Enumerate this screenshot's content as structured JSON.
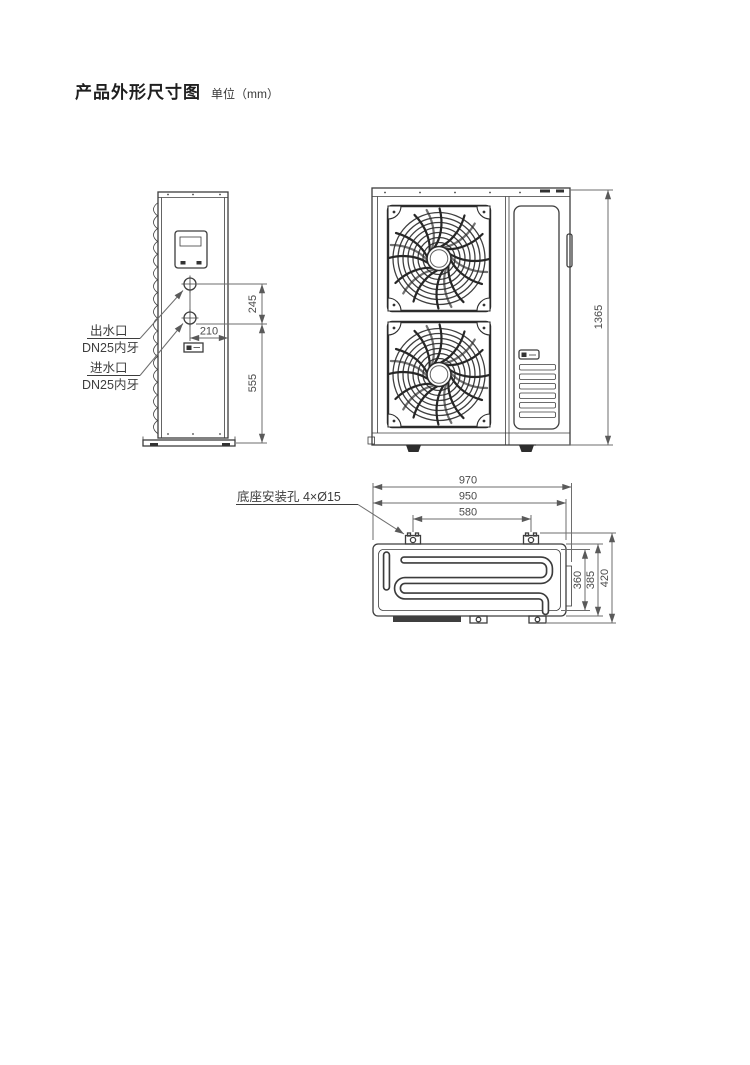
{
  "title": {
    "text": "产品外形尺寸图",
    "unit": "单位（mm）"
  },
  "side_view": {
    "outlet_label": [
      "出水口",
      "DN25内牙"
    ],
    "inlet_label": [
      "进水口",
      "DN25内牙"
    ],
    "dimensions": {
      "port_spacing": "245",
      "port_offset": "210",
      "inlet_height": "555"
    }
  },
  "front_view": {
    "dimensions": {
      "height": "1365"
    }
  },
  "bottom_view": {
    "mounting_label": "底座安装孔 4×Ø15",
    "dimensions": {
      "overall_width": "970",
      "base_width": "950",
      "hole_spacing": "580",
      "inner_depth": "360",
      "base_depth": "385",
      "overall_depth": "420"
    }
  },
  "colors": {
    "line": "#3d3d3d",
    "dimension": "#6e6e6e",
    "text": "#4a4a4a",
    "background": "#ffffff"
  }
}
